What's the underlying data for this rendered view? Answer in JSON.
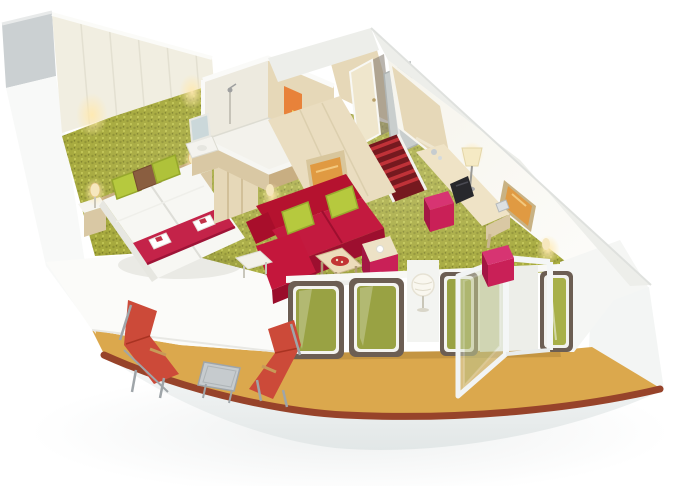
{
  "image": {
    "kind": "3d-cutaway-render",
    "description": "Isometric cutaway rendering of a cruise-ship balcony suite cabin on a white background",
    "width_px": 680,
    "height_px": 486
  },
  "scene": {
    "rooms": [
      {
        "name": "Bedroom",
        "items": [
          "Twin beds with white duvets",
          "Two lime-green pillows and one brown pillow",
          "Red bed runner with folded white towels",
          "Two wooden nightstands",
          "Two warm wall sconces",
          "Cream panelled back wall",
          "Light-wood wardrobe"
        ]
      },
      {
        "name": "Bathroom",
        "items": [
          "Walk-in shower with chrome fixture",
          "Orange hanging towel",
          "Yellow hanging towel",
          "White washbasin vanity with mirror",
          "Light-wood walls with white cut edges"
        ]
      },
      {
        "name": "Entrance",
        "items": [
          "Open light-wood cabin door",
          "Grey mirror panel",
          "Red striped stair carpet with white stringers"
        ]
      },
      {
        "name": "Living area",
        "items": [
          "Red two-seat sofa with two lime-green cushions",
          "Framed amber artwork above sofa",
          "Framed amber artwork on right wall",
          "Wood coffee table with red tray",
          "White side table",
          "Magenta ottoman with cream top",
          "Magenta desk stool",
          "Magenta pouf by balcony door",
          "Curved light-wood desk with table lamp, TV and phone",
          "Paper lantern on white pedestal",
          "Olive-green speckled carpet"
        ]
      },
      {
        "name": "Balcony",
        "items": [
          "Two red folding sun loungers",
          "Square metal side table",
          "Sand-yellow deck floor",
          "Dark-red wooden handrail",
          "White curved ship hull"
        ]
      }
    ],
    "glazing": [
      "Floor-to-ceiling window panels with dark bronze frames",
      "White-framed balcony door shown open onto the balcony"
    ]
  },
  "palette": {
    "background": "#FFFFFF",
    "hull_top": "#F7F8F8",
    "hull_bottom": "#E4E8E8",
    "hull_right": "#F3F5F4",
    "roof_white": "#EDEEEA",
    "grey_block": "#CBD0D2",
    "left_wall": "#F8F9F8",
    "parapet": "#FBFBF9",
    "cream_wall": "#F1EEE1",
    "wood_light": "#E6D8B8",
    "wood_mid": "#D9C8A4",
    "wood_dark": "#C8AE82",
    "carpet_base": "#A6A93C",
    "carpet_dot_dark": "#8E9130",
    "carpet_dot_light": "#C6CA57",
    "balcony_floor": "#DBA84D",
    "handrail": "#97432A",
    "sofa_red": "#C31A3F",
    "sofa_dark": "#9D0F2F",
    "lime": "#B6C93E",
    "runner_red": "#C42349",
    "pillow_brown": "#8A5E40",
    "magenta": "#C92057",
    "magenta_dark": "#A31644",
    "magenta_top": "#D73472",
    "lounger_red": "#CC4A39",
    "frame_grey": "#9FA5A9",
    "window_frame": "#6C5E53",
    "glass_green": "#99A243",
    "door_white": "#F2F4F4",
    "towel_orange": "#E8823A",
    "towel_yellow": "#EFD468",
    "art_amber": "#E09A42",
    "glow_warm": "#F6E7BE",
    "stripe_red": "#C03238",
    "stripe_dark": "#75191F",
    "tv_black": "#28282C",
    "mirror_glass": "#C9CECD",
    "duvet_white": "#F7F7F3",
    "tray_red": "#C23434"
  }
}
